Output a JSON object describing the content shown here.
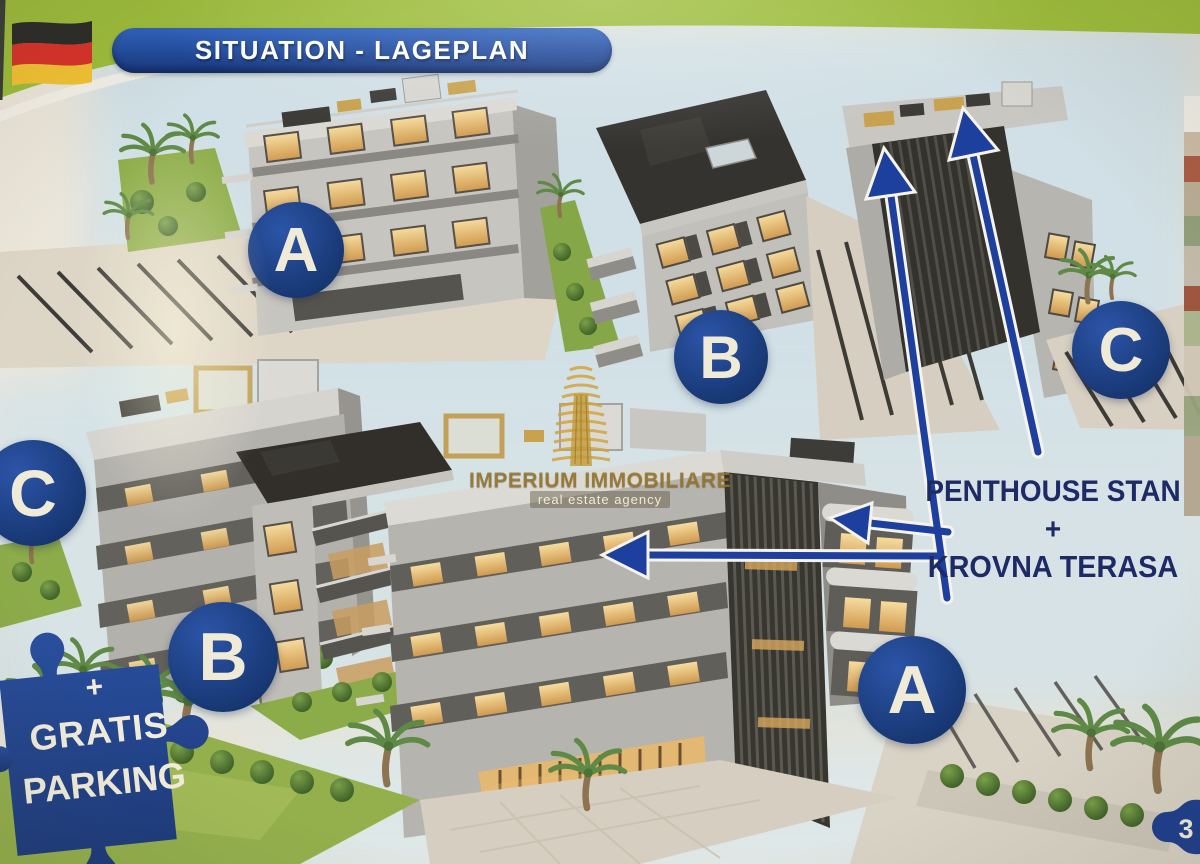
{
  "header": {
    "banner_label": "SITUATION - LAGEPLAN",
    "flag_icon": "german-flag"
  },
  "site_plan": {
    "top_row_labels": [
      "A",
      "B",
      "C"
    ],
    "bottom_row_labels": [
      "C",
      "B",
      "A"
    ]
  },
  "annotation": {
    "line1": "PENTHOUSE STAN +",
    "line2": "KROVNA TERASA"
  },
  "watermark": {
    "name": "IMPERIUM IMMOBILIARE",
    "tagline": "real estate agency"
  },
  "parking_badge": {
    "plus": "+",
    "word1": "GRATIS",
    "word2": "PARKING"
  },
  "page_corner_number": "3",
  "colors": {
    "banner_blue": "#1d3f8f",
    "label_circle_blue": "#1c3a7d",
    "arrow_blue": "#1d3f9e",
    "header_green": "#9dbd3c",
    "watermark_gold": "#c89b3c",
    "annotation_navy": "#1d2a66",
    "puzzle_blue": "#22448f"
  }
}
